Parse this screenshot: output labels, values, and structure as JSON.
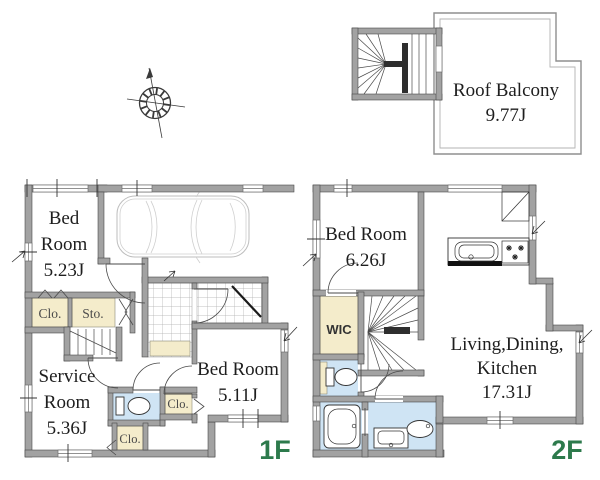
{
  "colors": {
    "wall_gray": "#a2a2a2",
    "closet_cream": "#f4eccb",
    "wet_blue": "#cfe4f4",
    "floor_label_green": "#2d7a4c"
  },
  "roof_plan": {
    "balcony_name": "Roof Balcony",
    "balcony_area": "9.77J"
  },
  "floor1": {
    "label": "1F",
    "bedroom1_line1": "Bed",
    "bedroom1_line2": "Room",
    "bedroom1_area": "5.23J",
    "service_line1": "Service",
    "service_line2": "Room",
    "service_area": "5.36J",
    "bedroom2_name": "Bed Room",
    "bedroom2_area": "5.11J",
    "closet_a": "Clo.",
    "storage": "Sto.",
    "closet_b": "Clo.",
    "closet_c": "Clo."
  },
  "floor2": {
    "label": "2F",
    "bedroom_name": "Bed Room",
    "bedroom_area": "6.26J",
    "wic": "WIC",
    "ldk_line1": "Living,Dining,",
    "ldk_line2": "Kitchen",
    "ldk_area": "17.31J"
  }
}
